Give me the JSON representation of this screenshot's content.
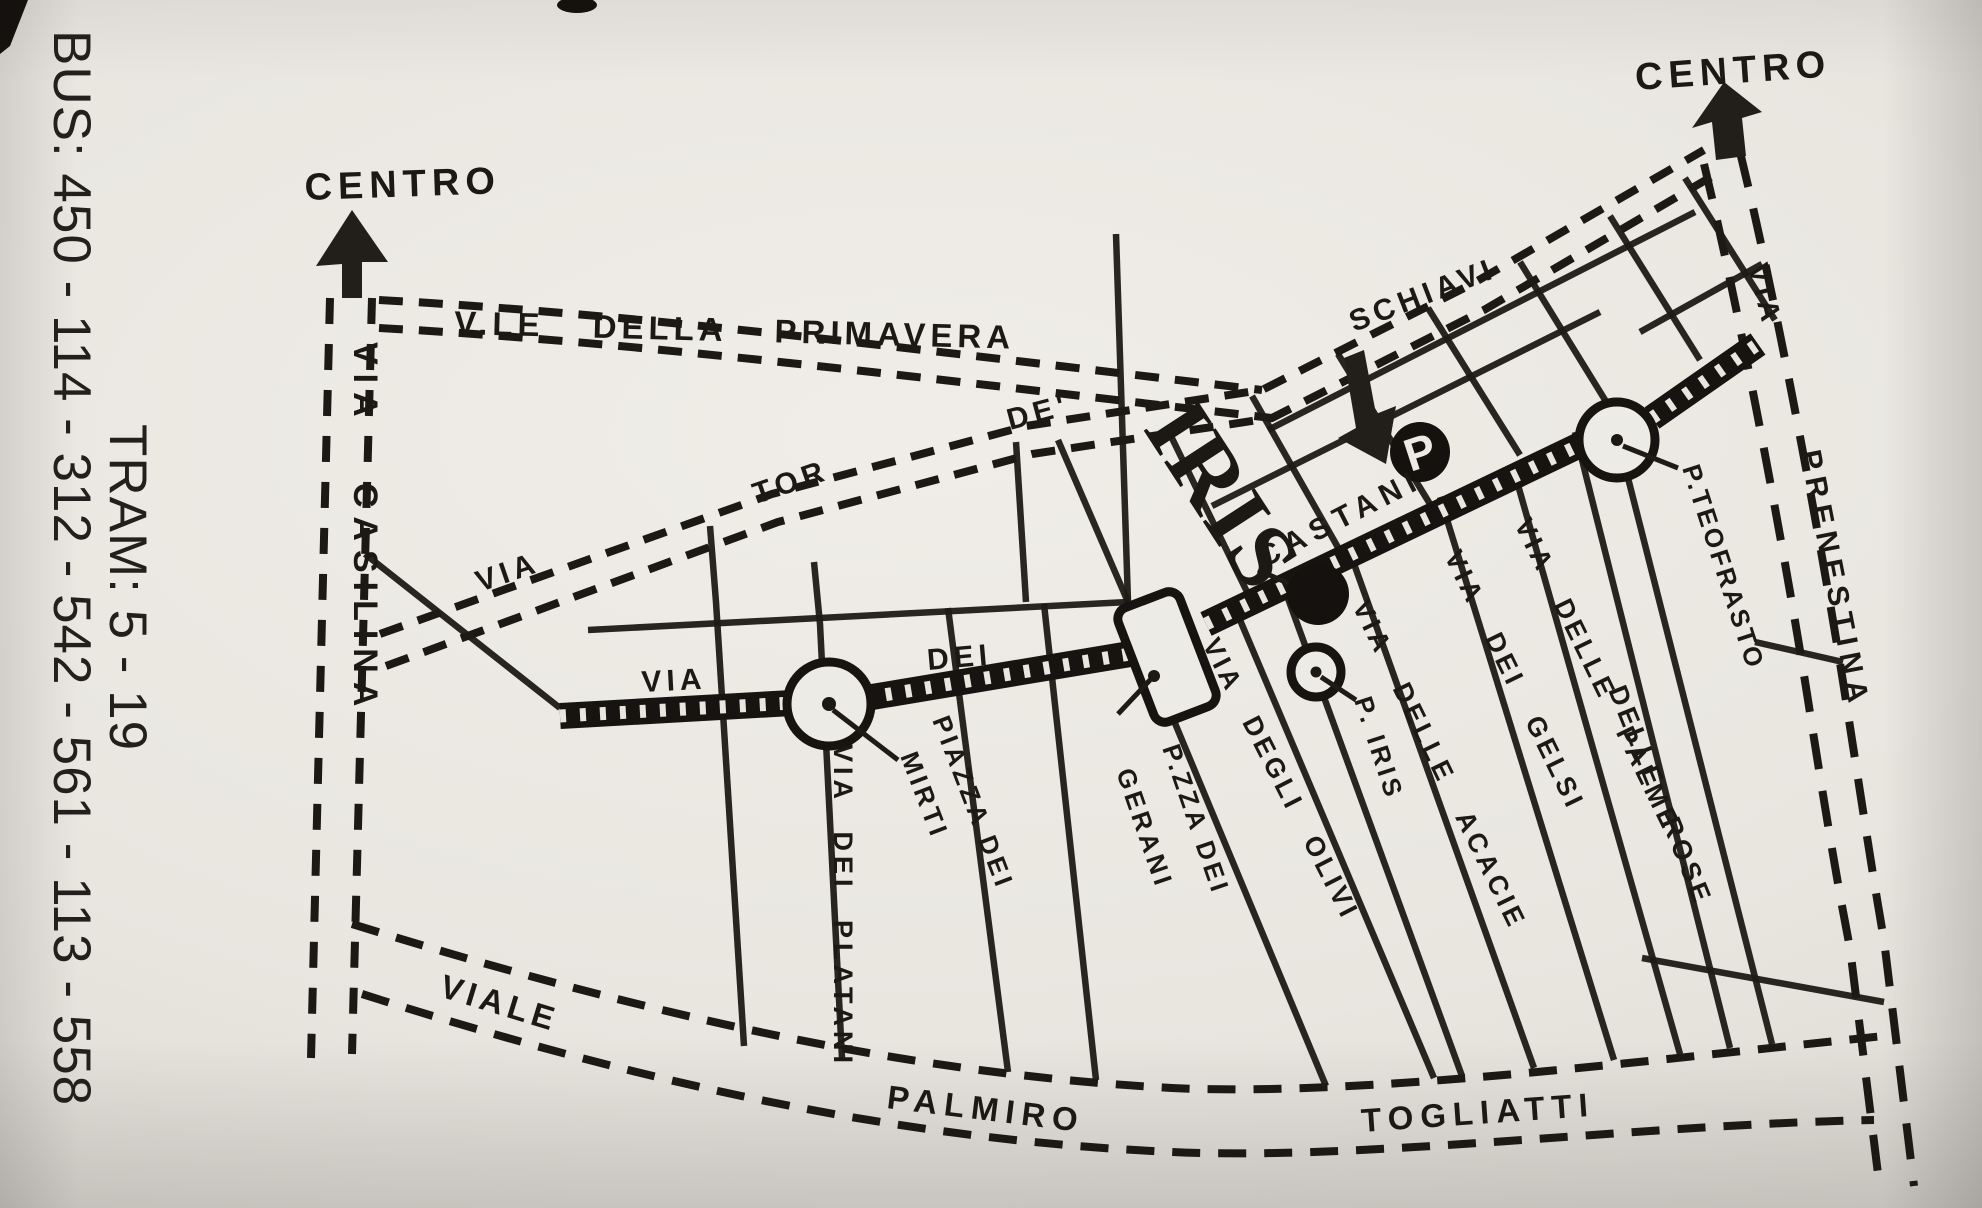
{
  "transit": {
    "bus": "BUS: 450 - 114 - 312 - 542 - 561 - 113 - 558",
    "tram": "TRAM: 5 - 19"
  },
  "directions": {
    "centro_left": "CENTRO",
    "centro_right": "CENTRO"
  },
  "venue": {
    "name": "IRIS",
    "parking": "P"
  },
  "roads": {
    "casilina": "VIA CASILINA",
    "primavera": "V.LE DELLA PRIMAVERA",
    "tor_de_schiavi": {
      "via": "VIA",
      "tor": "TOR",
      "de": "DE'",
      "schiavi": "SCHIAVI"
    },
    "castani": {
      "via": "VIA",
      "dei": "DEI",
      "name": "CASTANI"
    },
    "platani": "VIA DEI PLATANI",
    "olivi": "VIA DEGLI OLIVI",
    "acacie": "VIA DELLE ACACIE",
    "gelsi": "VIA DEI GELSI",
    "palme": "VIA DELLE PALME",
    "rose": "DELLE ROSE",
    "prenestina": {
      "via": "VIA",
      "name": "PRENESTINA"
    },
    "togliatti": {
      "viale": "VIALE",
      "palmiro": "PALMIRO",
      "name": "TOGLIATTI"
    }
  },
  "places": {
    "mirti": {
      "line1": "PIAZZA DEI",
      "line2": "MIRTI"
    },
    "gerani": {
      "line1": "P.ZZA DEI",
      "line2": "GERANI"
    },
    "iris_square": "P. IRIS",
    "teofrasto": "P.TEOFRASTO"
  },
  "colors": {
    "ink": "#1c1813",
    "paper": "#e9e6e0"
  }
}
